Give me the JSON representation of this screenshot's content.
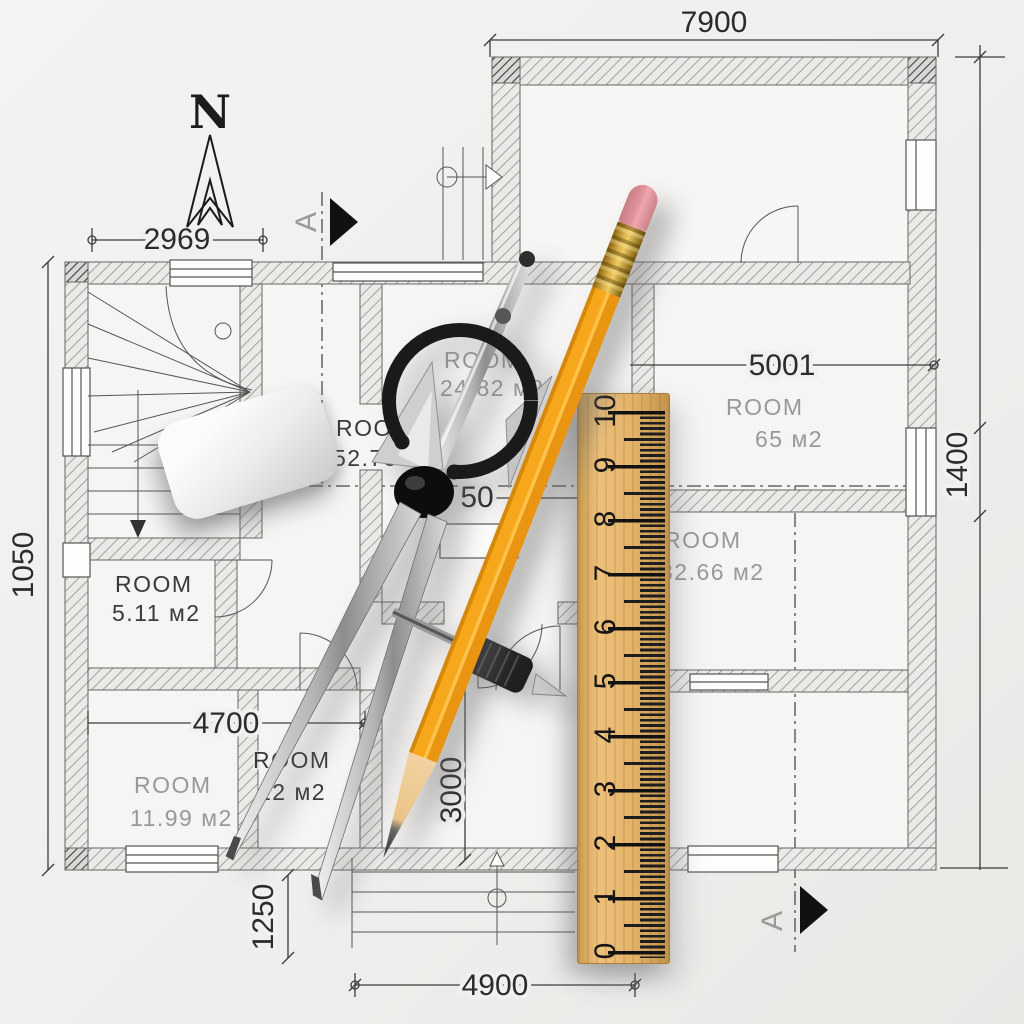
{
  "plan": {
    "north_label": "N",
    "dimensions": {
      "top": "7900",
      "stair_bay": "2969",
      "right_room": "5001",
      "partial_center": "50",
      "bottom_left_room": "4700",
      "hall_vertical": "3000",
      "porch_vertical": "1250",
      "bottom": "4900",
      "left_vertical": "1050",
      "right_vertical": "1400"
    },
    "section_markers": {
      "top": "A",
      "bottom": "A"
    },
    "rooms": [
      {
        "label": "ROOM",
        "area": "24.82 м2"
      },
      {
        "label": "ROOM",
        "area": "52.78"
      },
      {
        "label": "ROOM",
        "area": "5.11 м2"
      },
      {
        "label": "ROOM",
        "area": "65 м2"
      },
      {
        "label": "ROOM",
        "area": "32.66 м2"
      },
      {
        "label": "ROOM",
        "area": "11.99 м2"
      },
      {
        "label": "ROOM",
        "area": "12 м2"
      }
    ]
  },
  "ruler": {
    "numbers": [
      "0",
      "1",
      "2",
      "3",
      "4",
      "5",
      "6",
      "7",
      "8",
      "9",
      "10"
    ]
  },
  "colors": {
    "paper": "#f1f0ee",
    "plan-line": "#3c3c3c",
    "room-text-dark": "#3a3a3a",
    "room-text-gray": "#999999",
    "pencil-body": "#f7a71c",
    "pencil-eraser": "#e2939b",
    "pencil-ferrule": "#d9b04a",
    "ruler-wood": "#e5b167",
    "ruler-tick": "#1d1d1d"
  }
}
